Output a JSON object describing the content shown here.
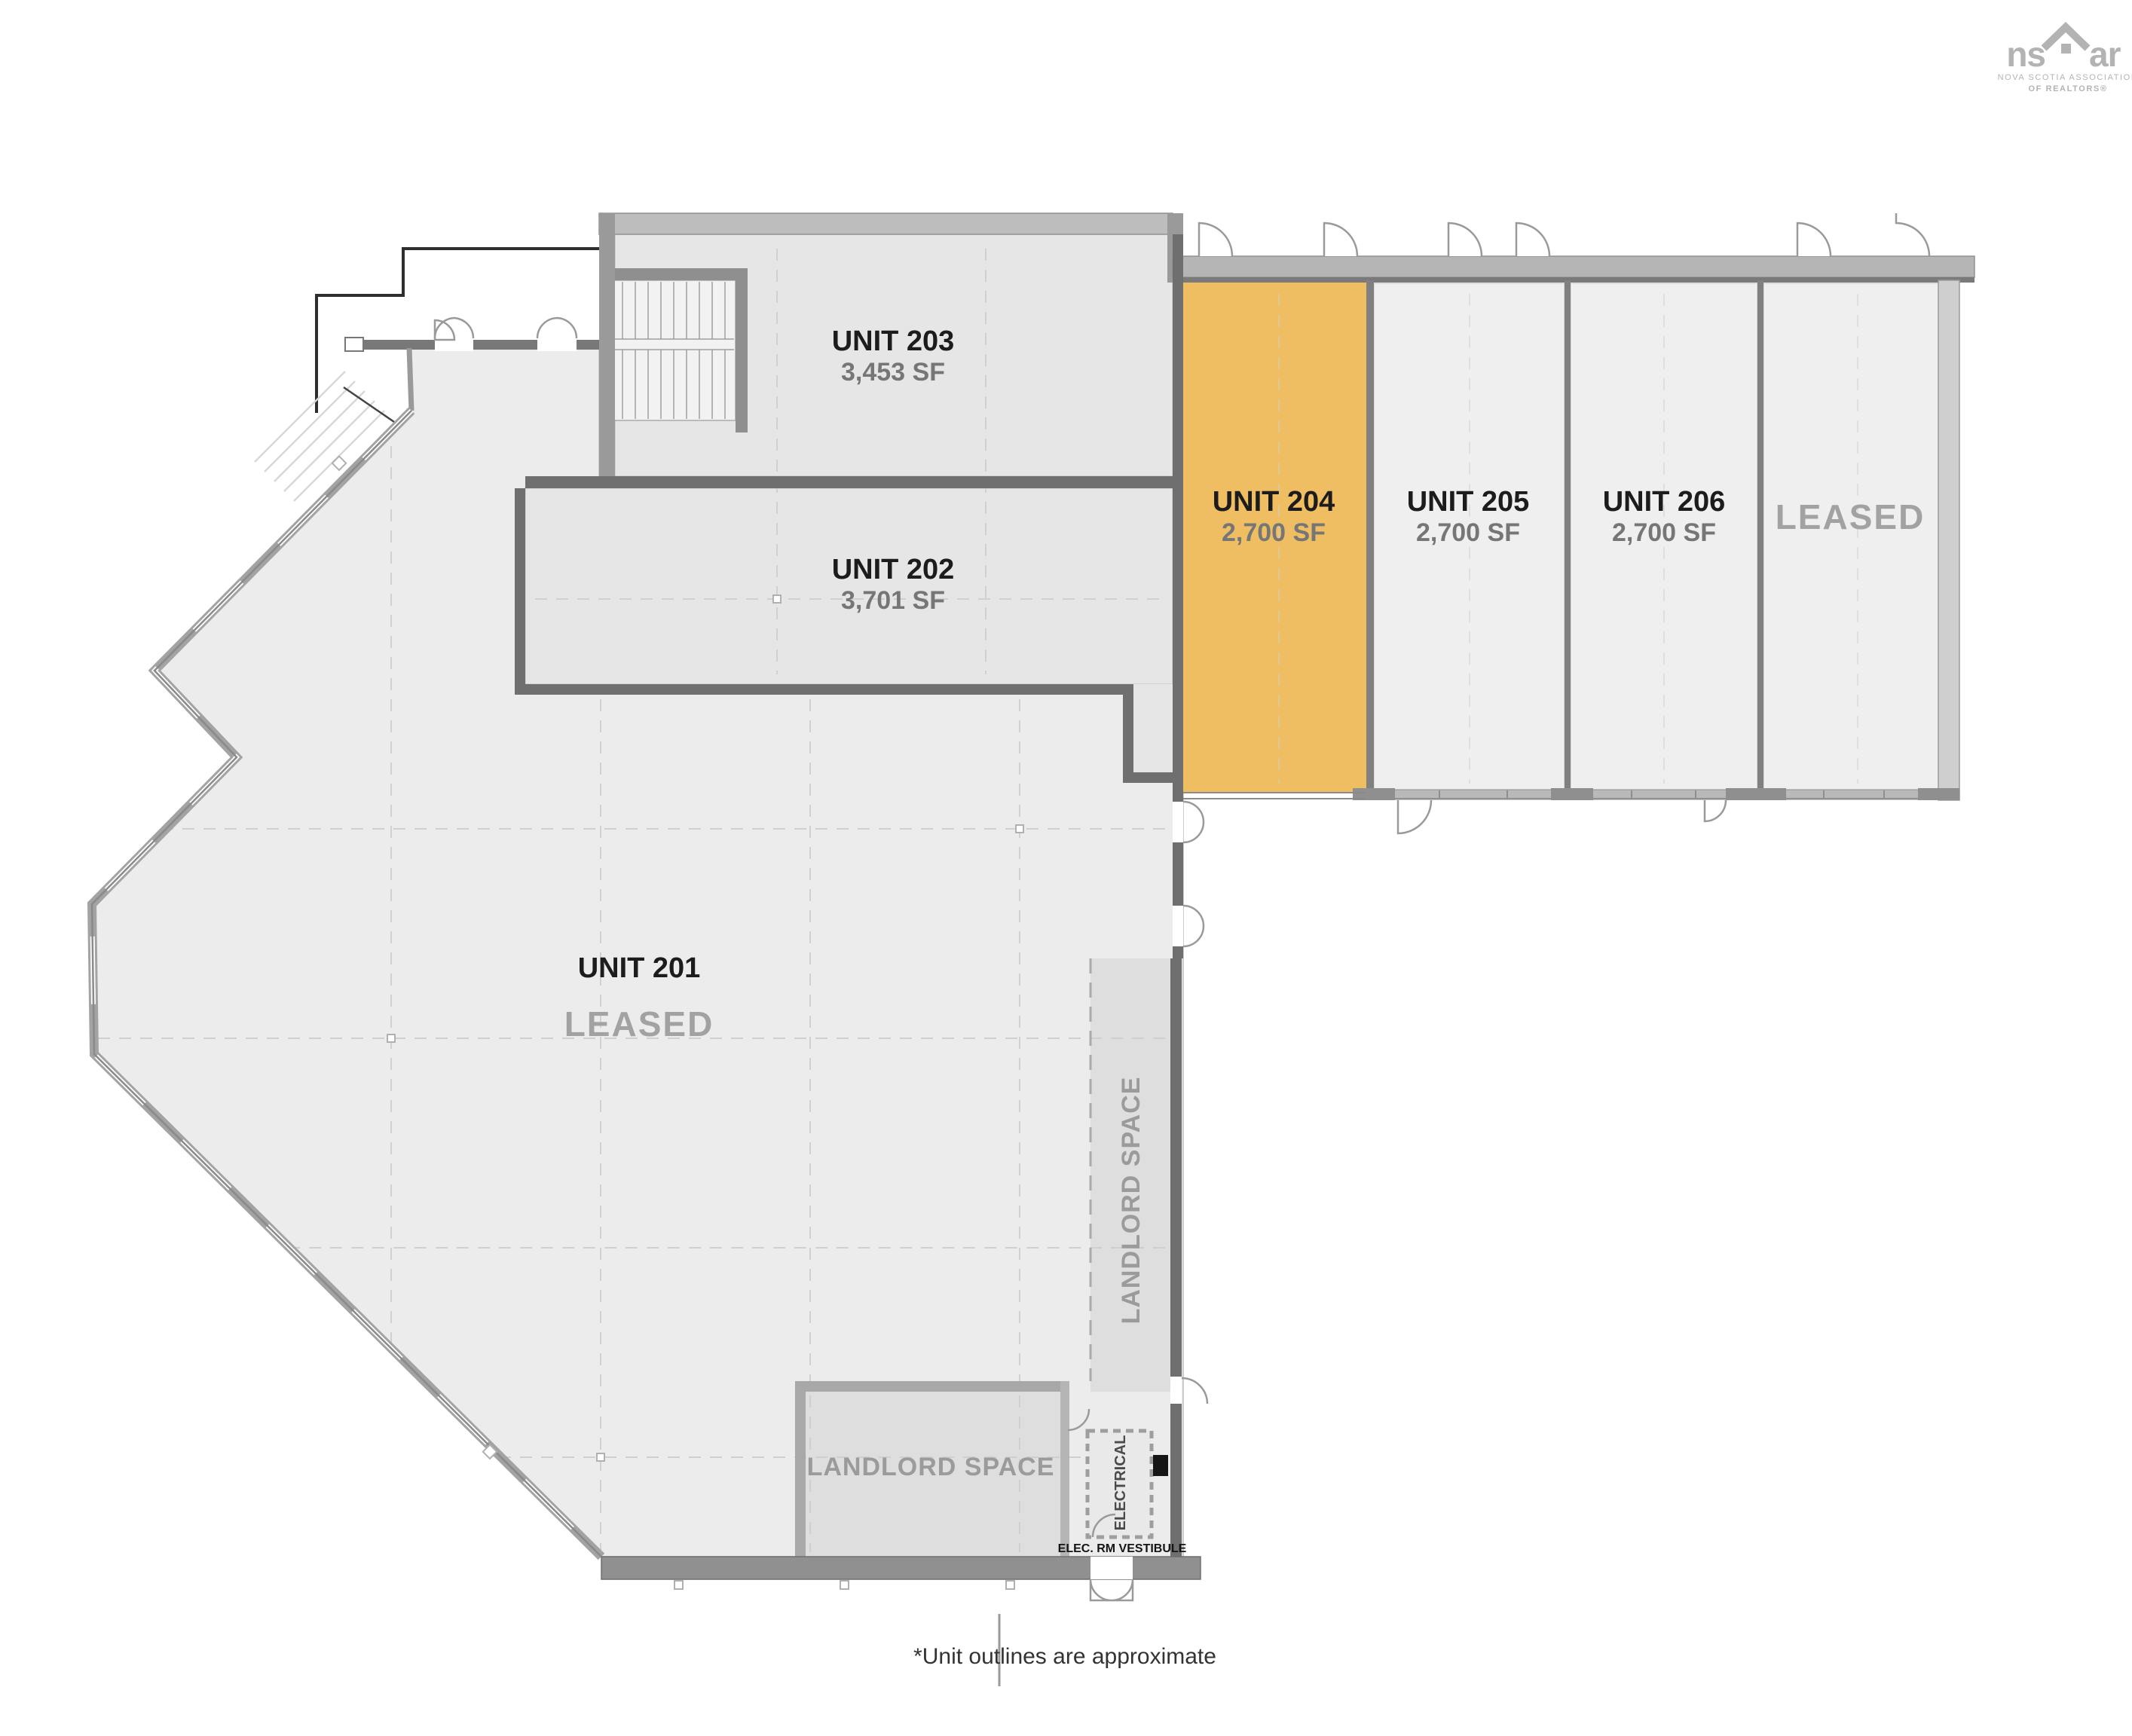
{
  "logo": {
    "brand_left": "ns",
    "brand_right": "ar",
    "tagline_line1": "NOVA SCOTIA ASSOCIATION",
    "tagline_line2": "OF REALTORS®"
  },
  "plan": {
    "units": {
      "u201": {
        "name": "UNIT 201",
        "status": "LEASED"
      },
      "u202": {
        "name": "UNIT 202",
        "area": "3,701 SF"
      },
      "u203": {
        "name": "UNIT 203",
        "area": "3,453 SF"
      },
      "u204": {
        "name": "UNIT 204",
        "area": "2,700 SF",
        "highlighted": true
      },
      "u205": {
        "name": "UNIT 205",
        "area": "2,700 SF"
      },
      "u206": {
        "name": "UNIT 206",
        "area": "2,700 SF"
      },
      "leased_east": {
        "status": "LEASED"
      }
    },
    "rooms": {
      "landlord_strip": "LANDLORD SPACE",
      "landlord_block": "LANDLORD SPACE",
      "electrical": "ELECTRICAL",
      "vestibule": "ELEC. RM VESTIBULE"
    }
  },
  "footnote": "*Unit outlines are approximate",
  "colors": {
    "highlight": "#F0BE62",
    "floor": "#ECECEC",
    "unit_floor": "#E6E6E6",
    "landlord_floor": "#DEDEDE",
    "wall_dark": "#6F6F6F",
    "wall_light": "#B5B5B5",
    "label_dark": "#1C1C1C",
    "label_gray": "#A2A2A2",
    "area_gray": "#767676",
    "logo_gray": "#B3B3B3"
  }
}
